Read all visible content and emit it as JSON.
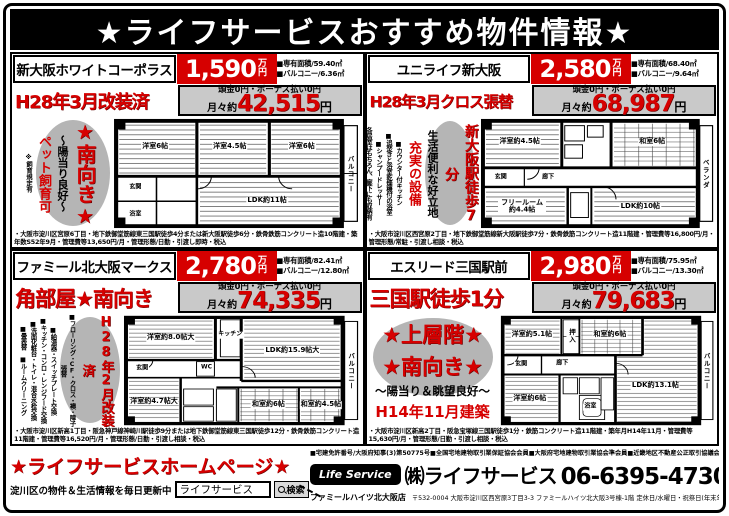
{
  "page": {
    "title": "★ライフサービスおすすめ物件情報★"
  },
  "colors": {
    "accent_red": "#d60000",
    "payment_bg": "#c9c9c9",
    "oval_gray": "#b5b5b5"
  },
  "properties": [
    {
      "name": "新大阪ホワイトコーポラス",
      "price": "1,590",
      "price_unit": "万円",
      "area": "■専有面積/59.40㎡",
      "balcony": "■バルコニー/6.36㎡",
      "catch": "H28年3月改装済",
      "payment_terms": "頭金0円・ボーナス払い0円",
      "monthly_prefix": "月々約",
      "monthly": "42,515",
      "monthly_unit": "円",
      "features": {
        "facing": "★南向き★",
        "sun": "～陽当り良好～",
        "pet": "ペット飼育可",
        "pet_note": "※飼育規定有"
      },
      "floorplan": {
        "balcony_label": "バルコニー",
        "rooms": [
          "洋室6帖",
          "洋室4.5帖",
          "洋室6帖",
          "LDK約11帖",
          "玄関",
          "浴室"
        ]
      },
      "fine_print": "・大阪市淀川区宮原6丁目・地下鉄御堂筋線東三国駅徒歩4分または新大阪駅徒歩6分・鉄骨鉄筋コンクリート造10階建・築年数S52年9月・管理費等13,650円/月・管理形態/日勤・引渡し即時・税込"
    },
    {
      "name": "ユニライフ新大阪",
      "price": "2,580",
      "price_unit": "万円",
      "area": "■専有面積/68.40㎡",
      "balcony": "■バルコニー/9.64㎡",
      "catch": "H28年3月クロス張替",
      "payment_terms": "頭金0円・ボーナス払い0円",
      "monthly_prefix": "月々約",
      "monthly": "68,987",
      "monthly_unit": "円",
      "features": {
        "station": "新大阪駅徒歩7分",
        "location": "生活便利な好立地",
        "equip": "充実の設備",
        "items": [
          "■カウンター付キッチン",
          "■追焚きと浴室乾燥機付の浴室",
          "■シャンプードレッサー",
          "各居室はもちろん、廊下にも収納有"
        ]
      },
      "floorplan": {
        "balcony_label": "ベランダ",
        "rooms": [
          "洋室約4.5帖",
          "和室6帖",
          "玄関",
          "廊下",
          "フリールーム約4.4帖",
          "LDK約10帖"
        ]
      },
      "fine_print": "・大阪市淀川区西宮原2丁目・地下鉄御堂筋線新大阪駅徒歩7分・鉄骨鉄筋コンクリート造11階建・管理費等16,800円/月・管理形態/常駐・引渡し相談・税込"
    },
    {
      "name": "ファミール北大阪マークス",
      "price": "2,780",
      "price_unit": "万円",
      "area": "■専有面積/82.41㎡",
      "balcony": "■バルコニー/12.80㎡",
      "catch": "角部屋★南向き",
      "payment_terms": "頭金0円・ボーナス払い0円",
      "monthly_prefix": "月々約",
      "monthly": "74,335",
      "monthly_unit": "円",
      "features": {
        "reform": "H28年2月改装済",
        "items": [
          "■フローリング・CF・クロス・襖・障子張替",
          "■給湯器・スイッチプレート交換",
          "■キッチン・コンロ・レンジフード交換",
          "■洗面化粧台・トイレ・混合水栓交換",
          "■畳表替 ■ルームクリーニング"
        ]
      },
      "floorplan": {
        "balcony_label": "バルコニー",
        "rooms": [
          "洋室約8.0帖大",
          "キッチン",
          "LDK約15.9帖大",
          "玄関",
          "WC",
          "洋室約4.7帖大",
          "和室約6帖",
          "和室約4.5帖"
        ]
      },
      "fine_print": "・大阪市淀川区新高1丁目・阪急神戸線神崎川駅徒歩9分または地下鉄御堂筋線東三国駅徒歩12分・鉄骨鉄筋コンクリート造11階建・管理費等16,520円/月・管理形態/日勤・引渡し相談・税込"
    },
    {
      "name": "エスリード三国駅前",
      "price": "2,980",
      "price_unit": "万円",
      "area": "■専有面積/75.95㎡",
      "balcony": "■バルコニー/13.30㎡",
      "catch": "三国駅徒歩1分",
      "payment_terms": "頭金0円・ボーナス払い0円",
      "monthly_prefix": "月々約",
      "monthly": "79,683",
      "monthly_unit": "円",
      "features": {
        "upper": "★上層階★",
        "facing": "★南向き★",
        "view": "～陽当り＆眺望良好～",
        "built": "H14年11月建築"
      },
      "floorplan": {
        "balcony_label": "バルコニー",
        "rooms": [
          "洋室約5.1帖",
          "押入",
          "和室約6帖",
          "玄関",
          "廊下",
          "洋室約6帖",
          "浴室",
          "LDK約13.1帖"
        ]
      },
      "fine_print": "・大阪市淀川区新高2丁目・阪急宝塚線三国駅徒歩1分・鉄筋コンクリート造11階建・築年月H14年11月・管理費等15,630円/月・管理形態/日勤・引渡し相談・税込"
    }
  ],
  "footer": {
    "homepage": "★ライフサービスホームページ★",
    "update": "淀川区の物件＆生活情報を毎日更新中",
    "search_value": "ライフサービス",
    "search_button": "検索",
    "license": "■宅建免許番号/大阪府知事(3)第50775号■全国宅地建物取引業保証協会会員■大阪府宅地建物取引業協会準会員■近畿地区不動産公正取引協議会加盟",
    "logo": "Life Service",
    "company": "㈱ライフサービス",
    "phone": "06-6395-4730(代)",
    "branch": "ファミールハイツ北大阪店",
    "address": "〒532-0004 大阪市淀川区西宮原3丁目3-3 ファミールハイツ北大阪3号棟-1階 定休日/水曜日・祝祭日(年末年始休み有)"
  }
}
